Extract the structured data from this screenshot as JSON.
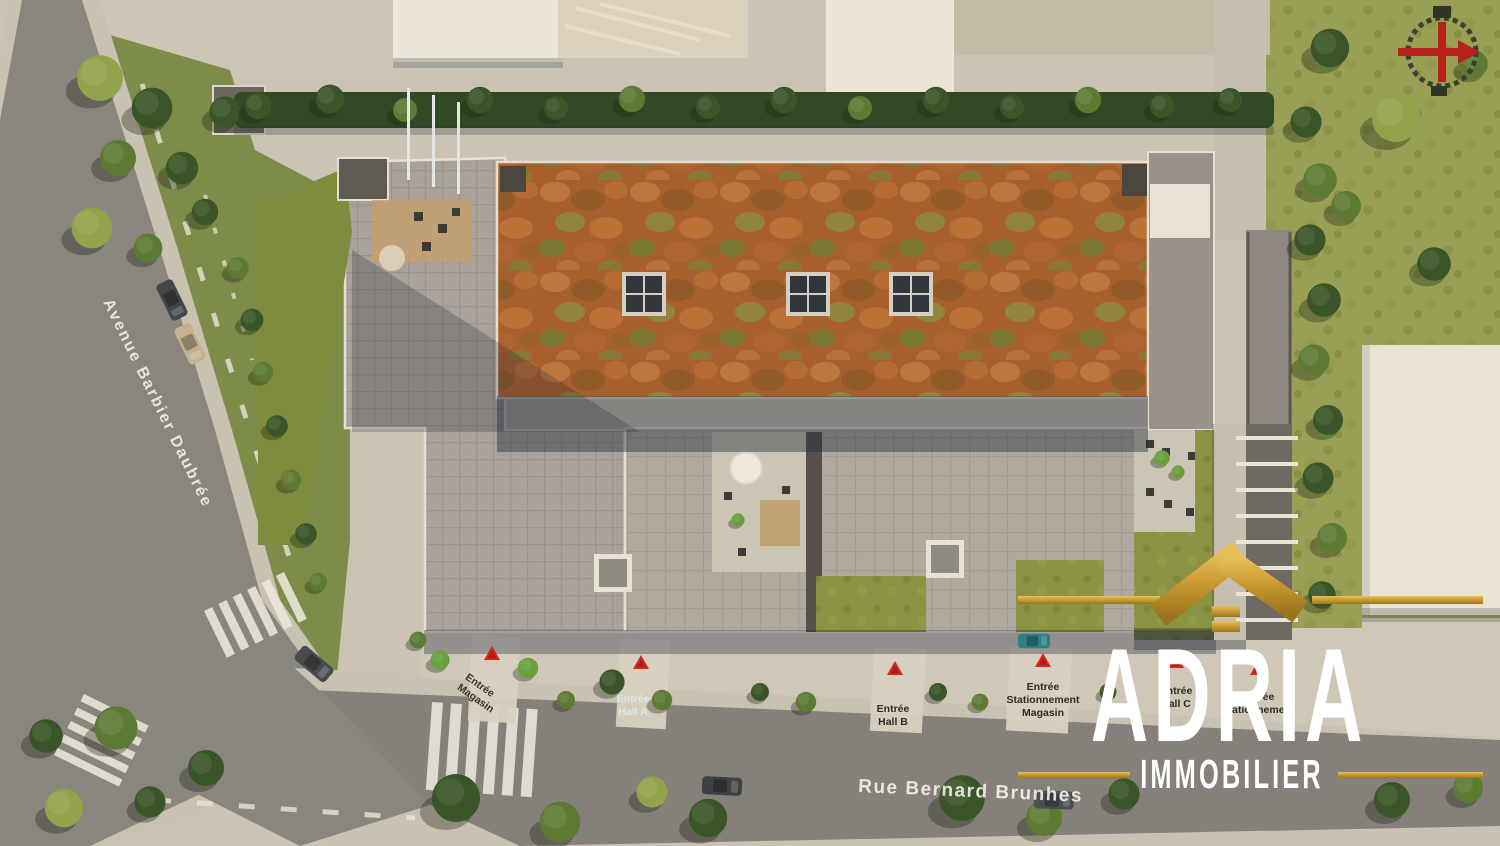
{
  "meta": {
    "view": "aerial-site-plan-render"
  },
  "streets": {
    "left": {
      "name": "Avenue Barbier Daubrée"
    },
    "bottom": {
      "name": "Rue Bernard Brunhes"
    }
  },
  "markers": [
    {
      "id": "entree-magasin",
      "lines": [
        "Entrée",
        "Magasin",
        ""
      ]
    },
    {
      "id": "entree-hall-a",
      "lines": [
        "Entrée",
        "Hall A",
        ""
      ]
    },
    {
      "id": "entree-hall-b",
      "lines": [
        "Entrée",
        "Hall B",
        ""
      ]
    },
    {
      "id": "entree-stationnement-magasin",
      "lines": [
        "Entrée",
        "Stationnement",
        "Magasin"
      ]
    },
    {
      "id": "entree-hall-c",
      "lines": [
        "Entrée",
        "Hall C",
        ""
      ]
    },
    {
      "id": "entree-stationnement",
      "lines": [
        "Entrée",
        "Stationnement",
        ""
      ]
    }
  ],
  "brand": {
    "name": "ADRIA",
    "tagline": "IMMOBILIER",
    "gold": "#c9992f",
    "text_color": "#ffffff"
  },
  "compass": {
    "needle_color": "#b8221c"
  },
  "palette": {
    "asphalt": "#8a857d",
    "paving": "#a8a29a",
    "sedum_roof": "#a85f2e",
    "lawn": "#99a055",
    "hedge": "#2f4a24",
    "shadow": "#222838",
    "pavement": "#cdc6b6",
    "marker_red": "#d3271d",
    "white_building": "#ece6d8"
  }
}
